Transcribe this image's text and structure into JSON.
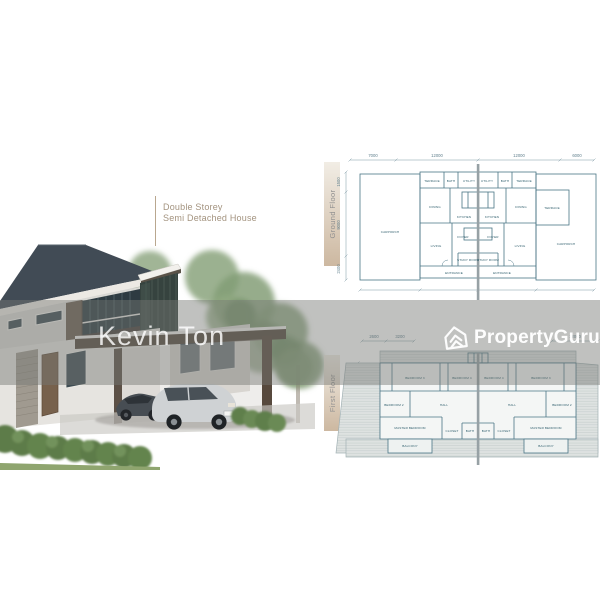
{
  "watermark": {
    "agent": "Kevin Ton"
  },
  "brand": {
    "name": "PropertyGuru"
  },
  "annotation": {
    "line1": "Double Storey",
    "line2": "Semi Detached House"
  },
  "plans": {
    "ground": {
      "title": "Ground Floor",
      "dims_top": [
        "7000",
        "12000",
        "12000",
        "6000"
      ],
      "dims_left": [
        "1500",
        "9000",
        "2400"
      ],
      "rooms": {
        "carporch": "CARPORCH",
        "terrace": "TERRACE",
        "bath": "BATH",
        "utility": "UTILITY",
        "dining": "DINING",
        "kitchen": "KITCHEN",
        "living": "LIVING",
        "foyer": "FOYER",
        "study": "STUDY ROOM",
        "entrance": "ENTRANCE"
      }
    },
    "first": {
      "title": "First Floor",
      "dims_top": [
        "2600",
        "3200",
        "12000"
      ],
      "dims_left": [
        "9000"
      ],
      "rooms": {
        "bedroom2": "BEDROOM 2",
        "bedroom3": "BEDROOM 3",
        "bedroom4": "BEDROOM 4",
        "master": "MASTER BEDROOM",
        "hall": "HALL",
        "bath": "BATH",
        "closet": "CLOSET",
        "balcony": "BALCONY"
      }
    }
  },
  "colors": {
    "plan_line": "#4a7585",
    "annotation_text": "#a3937f",
    "watermark_text": "#ffffff",
    "band_overlay": "rgba(118,120,116,0.46)",
    "roof": "#414b55",
    "gradient_bar": "#c7b096"
  }
}
